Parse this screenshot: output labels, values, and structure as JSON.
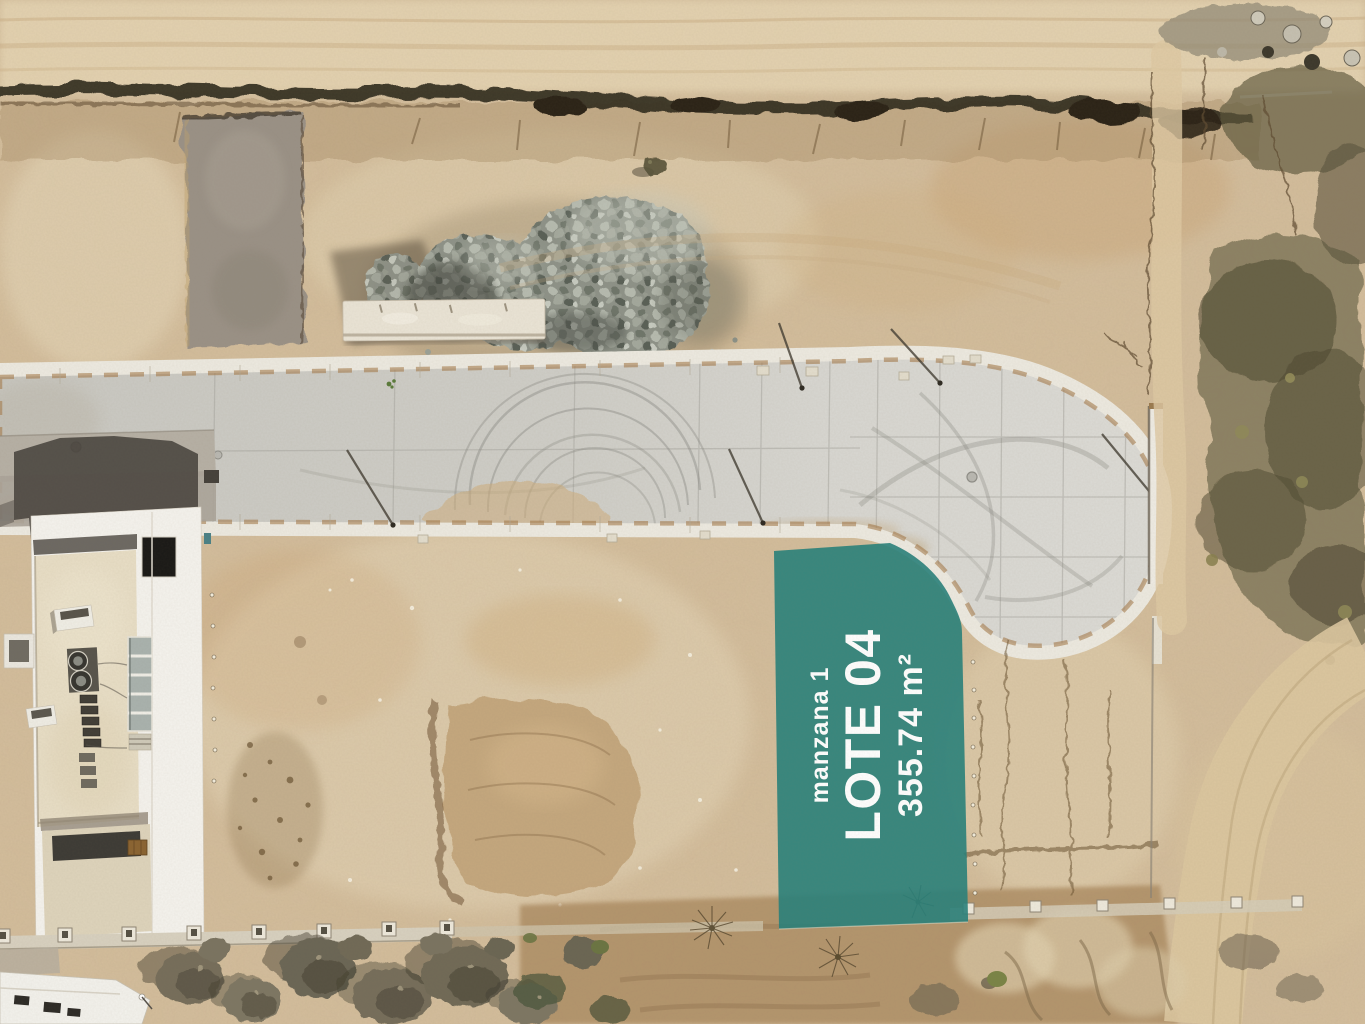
{
  "lot_overlay": {
    "block_label": "manzana 1",
    "lot_label": "LOTE 04",
    "area_label": "355.74 m²",
    "overlay_color": "#27817B",
    "label_color": "#FFFFFF"
  }
}
